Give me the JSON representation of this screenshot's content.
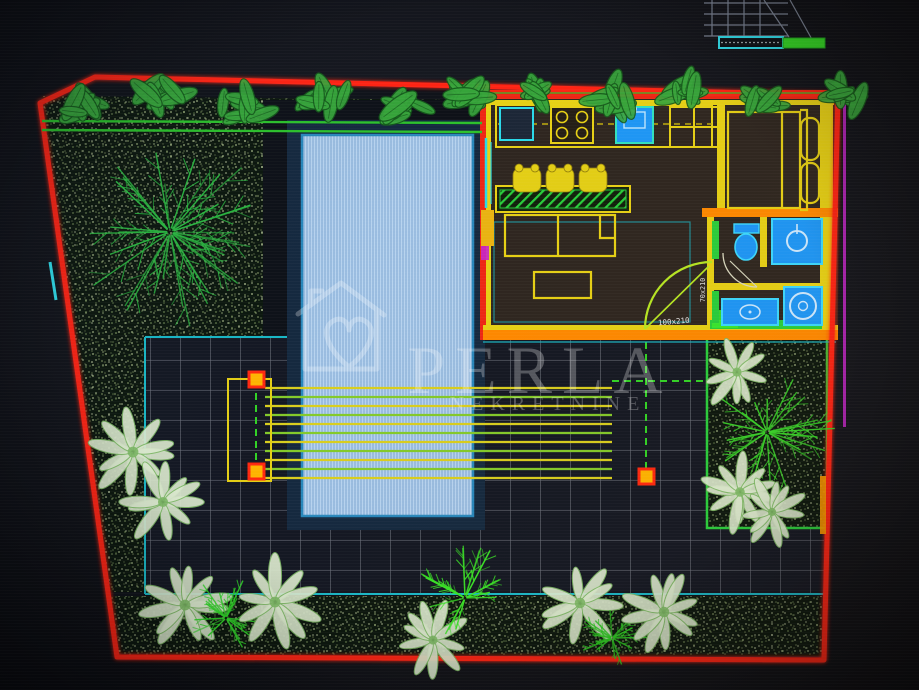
{
  "watermark": {
    "brand": "PERLA",
    "subtitle": "NEKRETNINE"
  },
  "labels": {
    "terrace_door_size": "100x210",
    "bathroom_door_size": "70x210"
  },
  "colors": {
    "boundary_red": "#ff2817",
    "wall_yellow": "#e6d11c",
    "wall_orange": "#ff8a00",
    "accent_cyan": "#2fd9e8",
    "line_green": "#33d22a",
    "planter_green": "#2ecc40",
    "pool_fill": "#a9c9e9",
    "pool_border": "#2b86b8",
    "fixture_blue": "#2196f3",
    "grass_dot": "#d8ecb0",
    "magenta_line": "#c228c8",
    "watermark_white": "#ffffff"
  },
  "icons": {
    "brand_logo": "house-heart-logo",
    "kitchen": [
      "fridge-icon",
      "stove-icon",
      "sink-icon",
      "cabinet-grid"
    ],
    "bathroom": [
      "toilet-icon",
      "shower-icon",
      "vanity-sink-icon",
      "washing-machine-icon"
    ],
    "furniture": [
      "bar-stool-icon",
      "bed-icon",
      "pillow",
      "sofa",
      "coffee-table"
    ],
    "landscape": [
      "hedge-shrub-icon",
      "fern-tree-icon",
      "palm-tree-icon"
    ],
    "misc": [
      "scale-bar",
      "survey-grid",
      "door-swing-arc",
      "pergola-posts"
    ]
  }
}
